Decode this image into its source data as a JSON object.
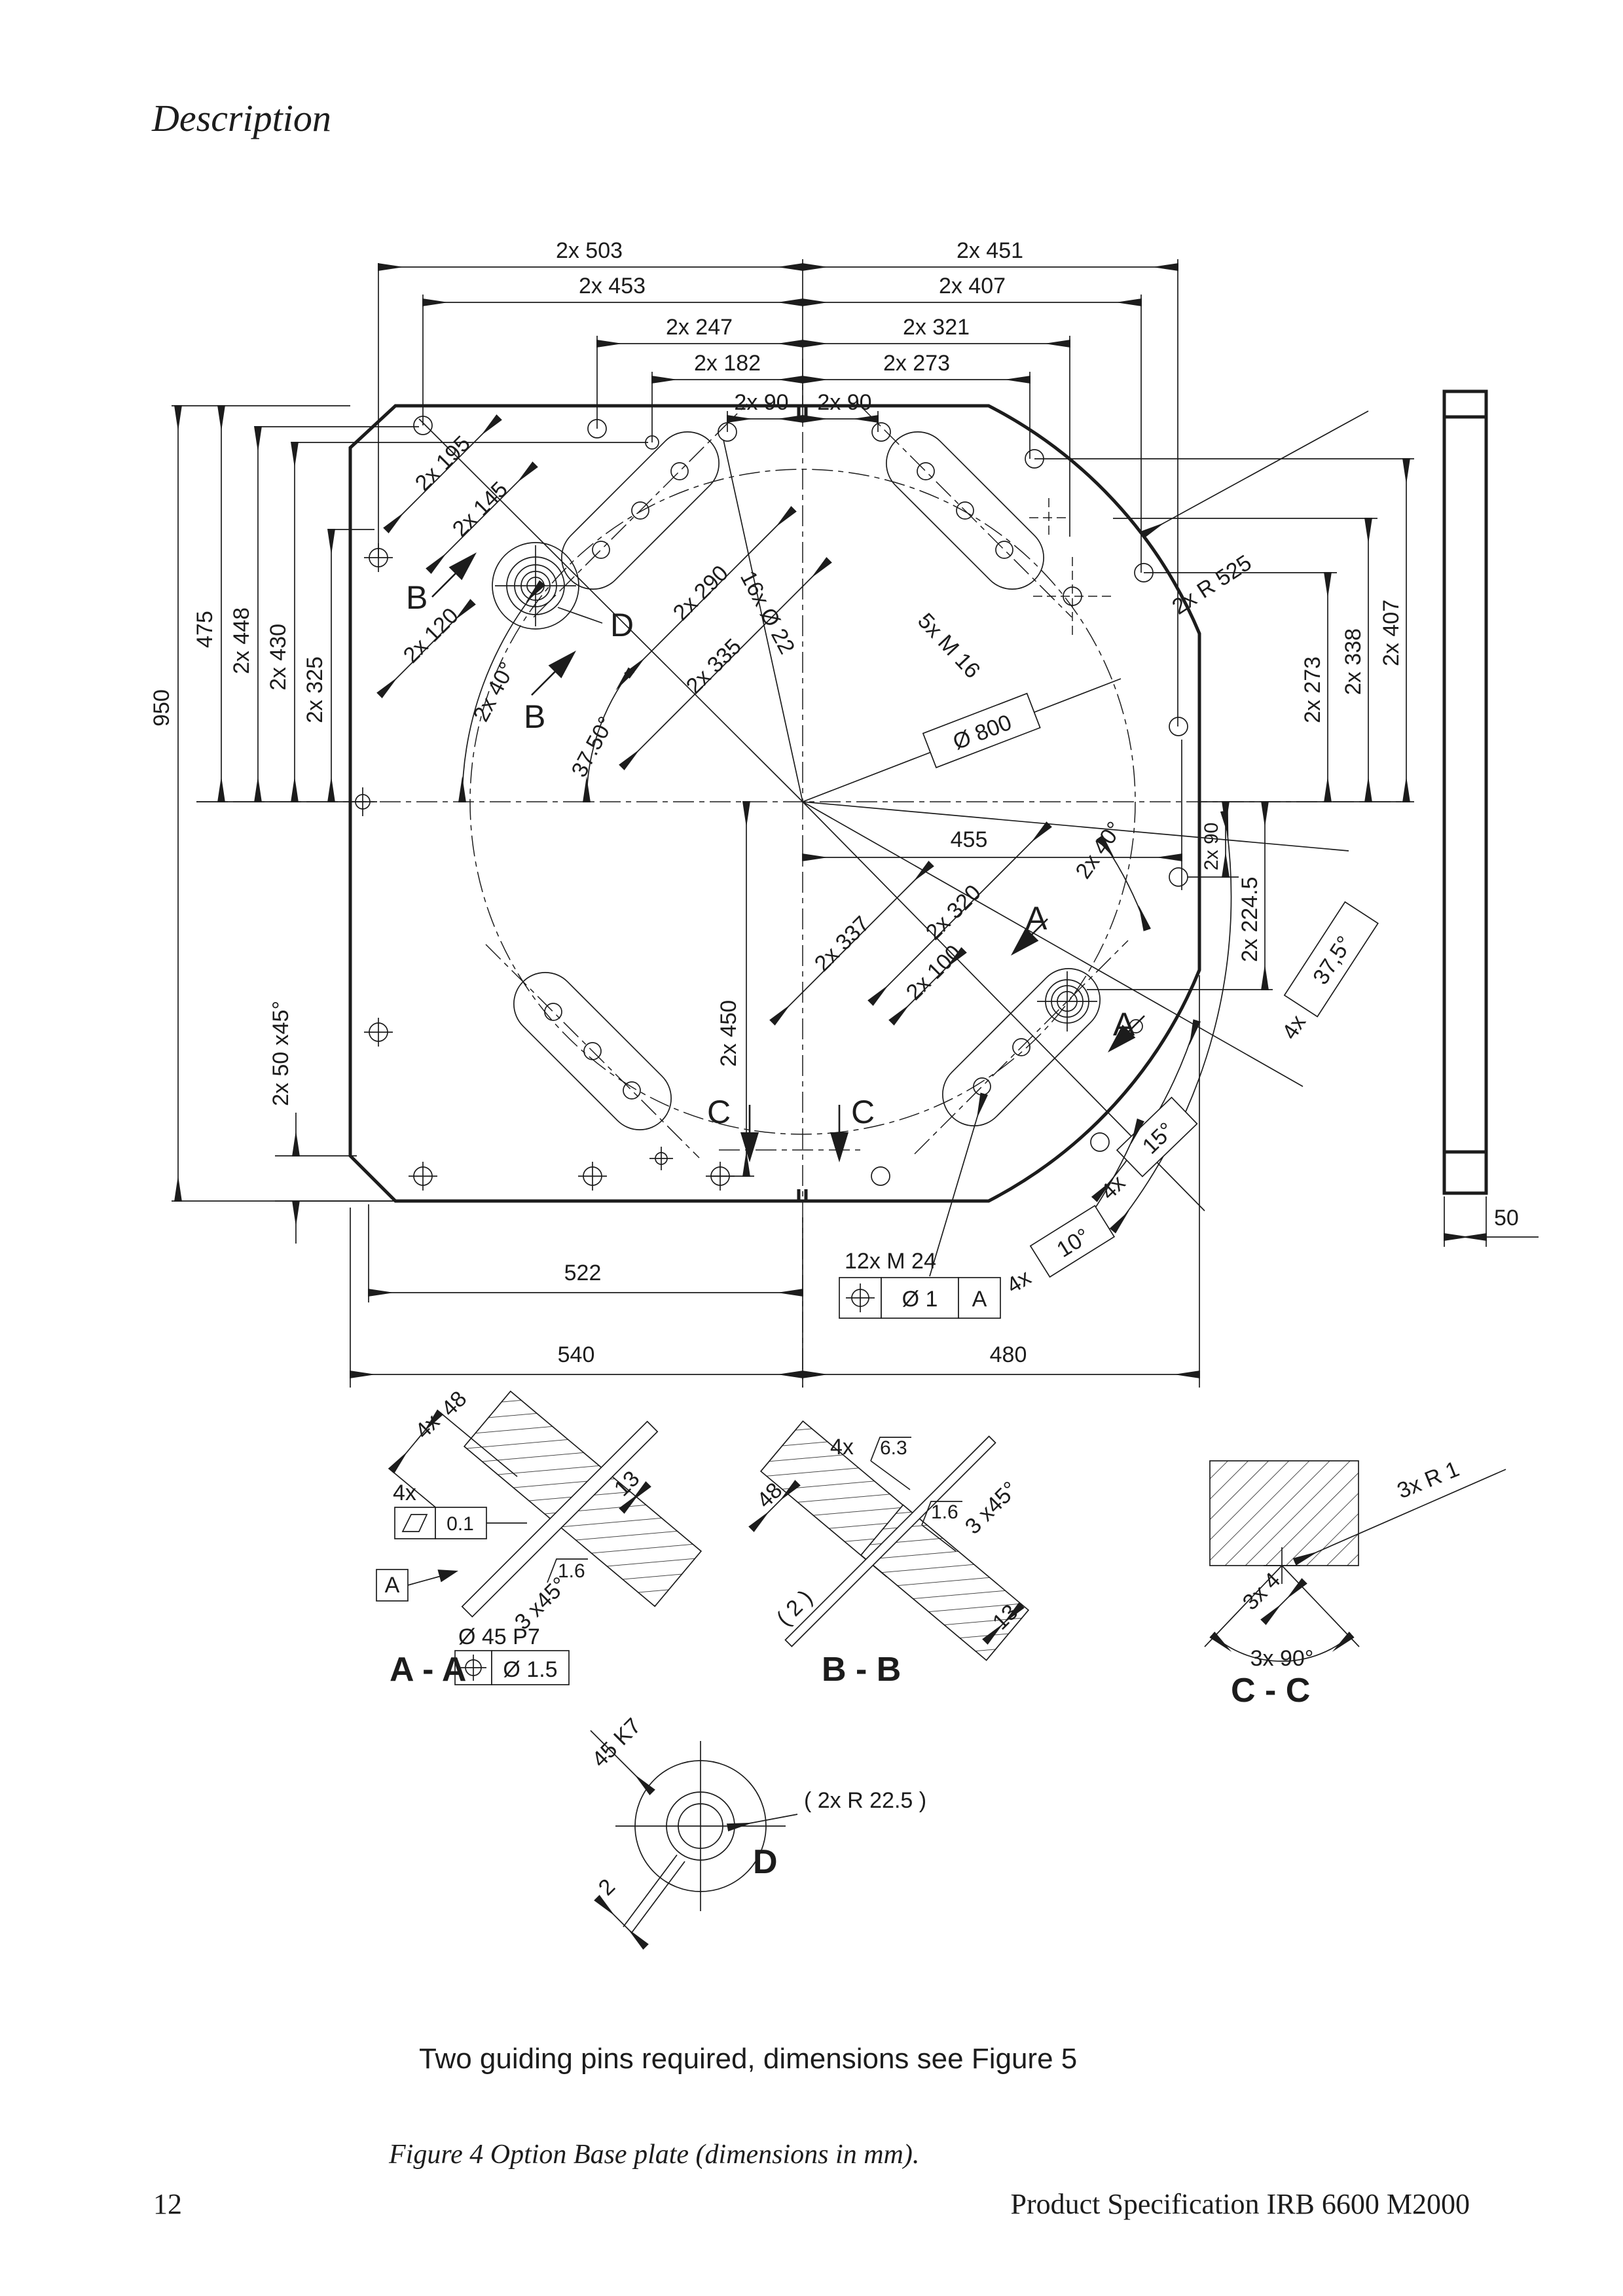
{
  "page": {
    "heading": "Description"
  },
  "footer": {
    "page_number": "12",
    "doc_title": "Product Specification IRB 6600 M2000"
  },
  "captions": {
    "note": "Two guiding pins required, dimensions see Figure 5",
    "figure": "Figure 4  Option Base plate (dimensions in mm)."
  },
  "side_view": {
    "thickness": "50"
  },
  "labels": {
    "top_r1l": "2x 503",
    "top_r1r": "2x 451",
    "top_r2l": "2x 453",
    "top_r2r": "2x 407",
    "top_r3l": "2x 247",
    "top_r3r": "2x 321",
    "top_r4l": "2x 182",
    "top_r4r": "2x 273",
    "top_r5l": "2x 90",
    "top_r5r": "2x 90",
    "left_950": "950",
    "left_475": "475",
    "left_448": "2x 448",
    "left_430": "2x 430",
    "left_325": "2x 325",
    "left_chamfer": "2x 50 x45°",
    "diag_195": "2x 195",
    "diag_145": "2x 145",
    "diag_120": "2x 120",
    "ang_40_up": "2x 40°",
    "ang_3750": "37.50°",
    "holes_16": "16x Ø 22",
    "diag_290": "2x 290",
    "diag_335": "2x 335",
    "thread_5m16": "5x M 16",
    "dia_800": "Ø  800",
    "radius_525": "2x R 525",
    "right_273": "2x 273",
    "right_338": "2x 338",
    "right_407": "2x 407",
    "right_90": "2x 90",
    "right_2245": "2x 224.5",
    "dim_455": "455",
    "ang_40_low": "2x 40°",
    "diag_320": "2x 320",
    "diag_337": "2x 337",
    "diag_100": "2x 100",
    "dim_450": "2x 450",
    "ang_375_pre": "4x",
    "ang_375": "37,5°",
    "ang_15_pre": "4x",
    "ang_15": "15°",
    "ang_10_pre": "4x",
    "ang_10": "10°",
    "bot_522": "522",
    "bot_540": "540",
    "bot_480": "480",
    "thread_12m24": "12x M  24",
    "fcf_dia": "Ø 1",
    "fcf_datum": "A",
    "mark_b1": "B",
    "mark_b2": "B",
    "mark_c1": "C",
    "mark_c2": "C",
    "mark_a1": "A",
    "mark_a2": "A",
    "mark_d": "D"
  },
  "section_aa": {
    "qty_48": "4x",
    "dim_48": "48",
    "qty_fcf": "4x",
    "flatness": "0.1",
    "datum": "A",
    "dim_13": "13",
    "finish": "1.6",
    "chamfer": "3 x45°",
    "pin_dia": "Ø 45 P7",
    "fcf_tol": "Ø 1.5",
    "title": "A - A"
  },
  "section_bb": {
    "qty": "4x",
    "finish_63": "6.3",
    "dim_48": "48",
    "finish_16": "1.6",
    "chamfer": "3 x45°",
    "dim_2": "( 2 )",
    "dim_13": "13",
    "title": "B - B"
  },
  "section_cc": {
    "radius": "3x R 1",
    "dim_4": "3x 4",
    "angle": "3x 90°",
    "title": "C - C"
  },
  "detail_d": {
    "fit": "45 K7",
    "dim_2": "2",
    "radius": "( 2x R 22.5 )",
    "title": "D"
  }
}
